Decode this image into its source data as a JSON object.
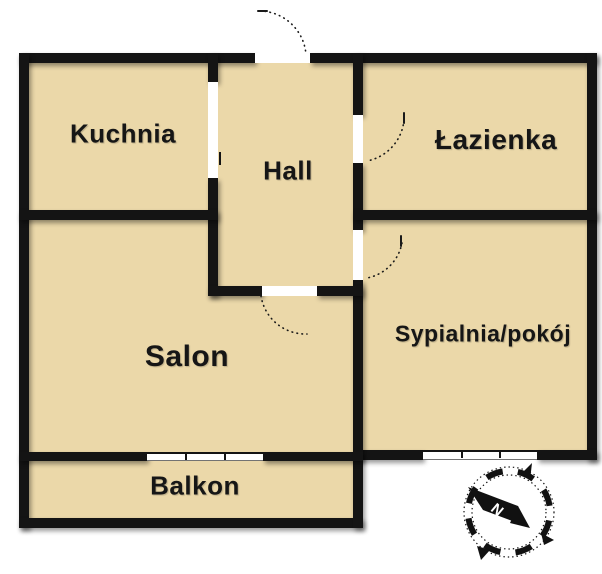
{
  "rooms": [
    {
      "label": "Kuchnia"
    },
    {
      "label": "Hall"
    },
    {
      "label": "Łazienka"
    },
    {
      "label": "Sypialnia/pokój"
    },
    {
      "label": "Salon"
    },
    {
      "label": "Balkon"
    }
  ],
  "compass": {
    "north_label": "N"
  },
  "colors": {
    "floor": "#ebd8a9",
    "wall": "#141414",
    "background": "#ffffff",
    "opening": "#ffffff"
  }
}
